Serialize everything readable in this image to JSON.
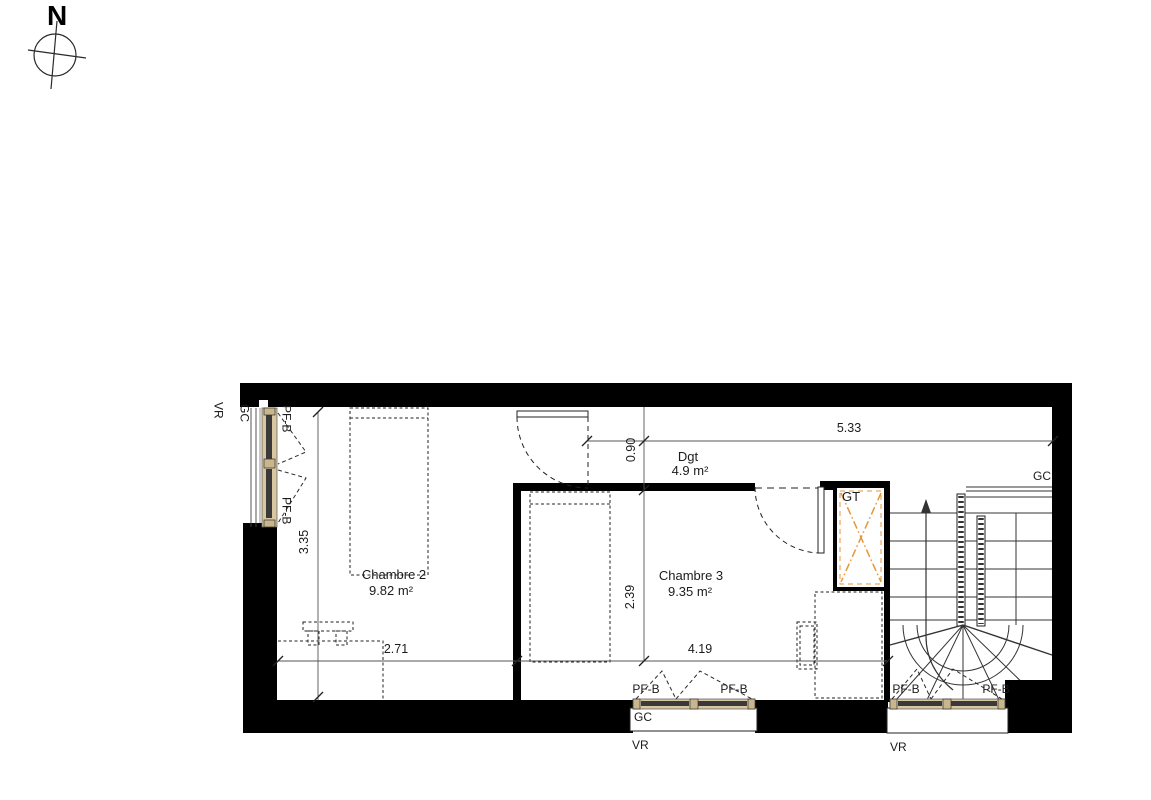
{
  "compass": {
    "north": "N"
  },
  "rooms": {
    "chambre2": {
      "name": "Chambre 2",
      "area": "9.82 m²"
    },
    "chambre3": {
      "name": "Chambre 3",
      "area": "9.35 m²"
    },
    "degagement": {
      "name": "Dgt",
      "area": "4.9 m²"
    },
    "gaine": {
      "name": "GT"
    }
  },
  "dimensions": {
    "top_width": "5.33",
    "door_width": "0.90",
    "left_height": "3.35",
    "chambre3_height": "2.39",
    "chambre2_width": "2.71",
    "chambre3_width": "4.19"
  },
  "labels": {
    "window": "PF-B",
    "guardrail": "GC",
    "shutter": "VR"
  },
  "colors": {
    "wall": "#000000",
    "accent_orange": "#e8953a",
    "window_frame": "#d8c7a0",
    "window_glazing": "#3a3a3a"
  }
}
